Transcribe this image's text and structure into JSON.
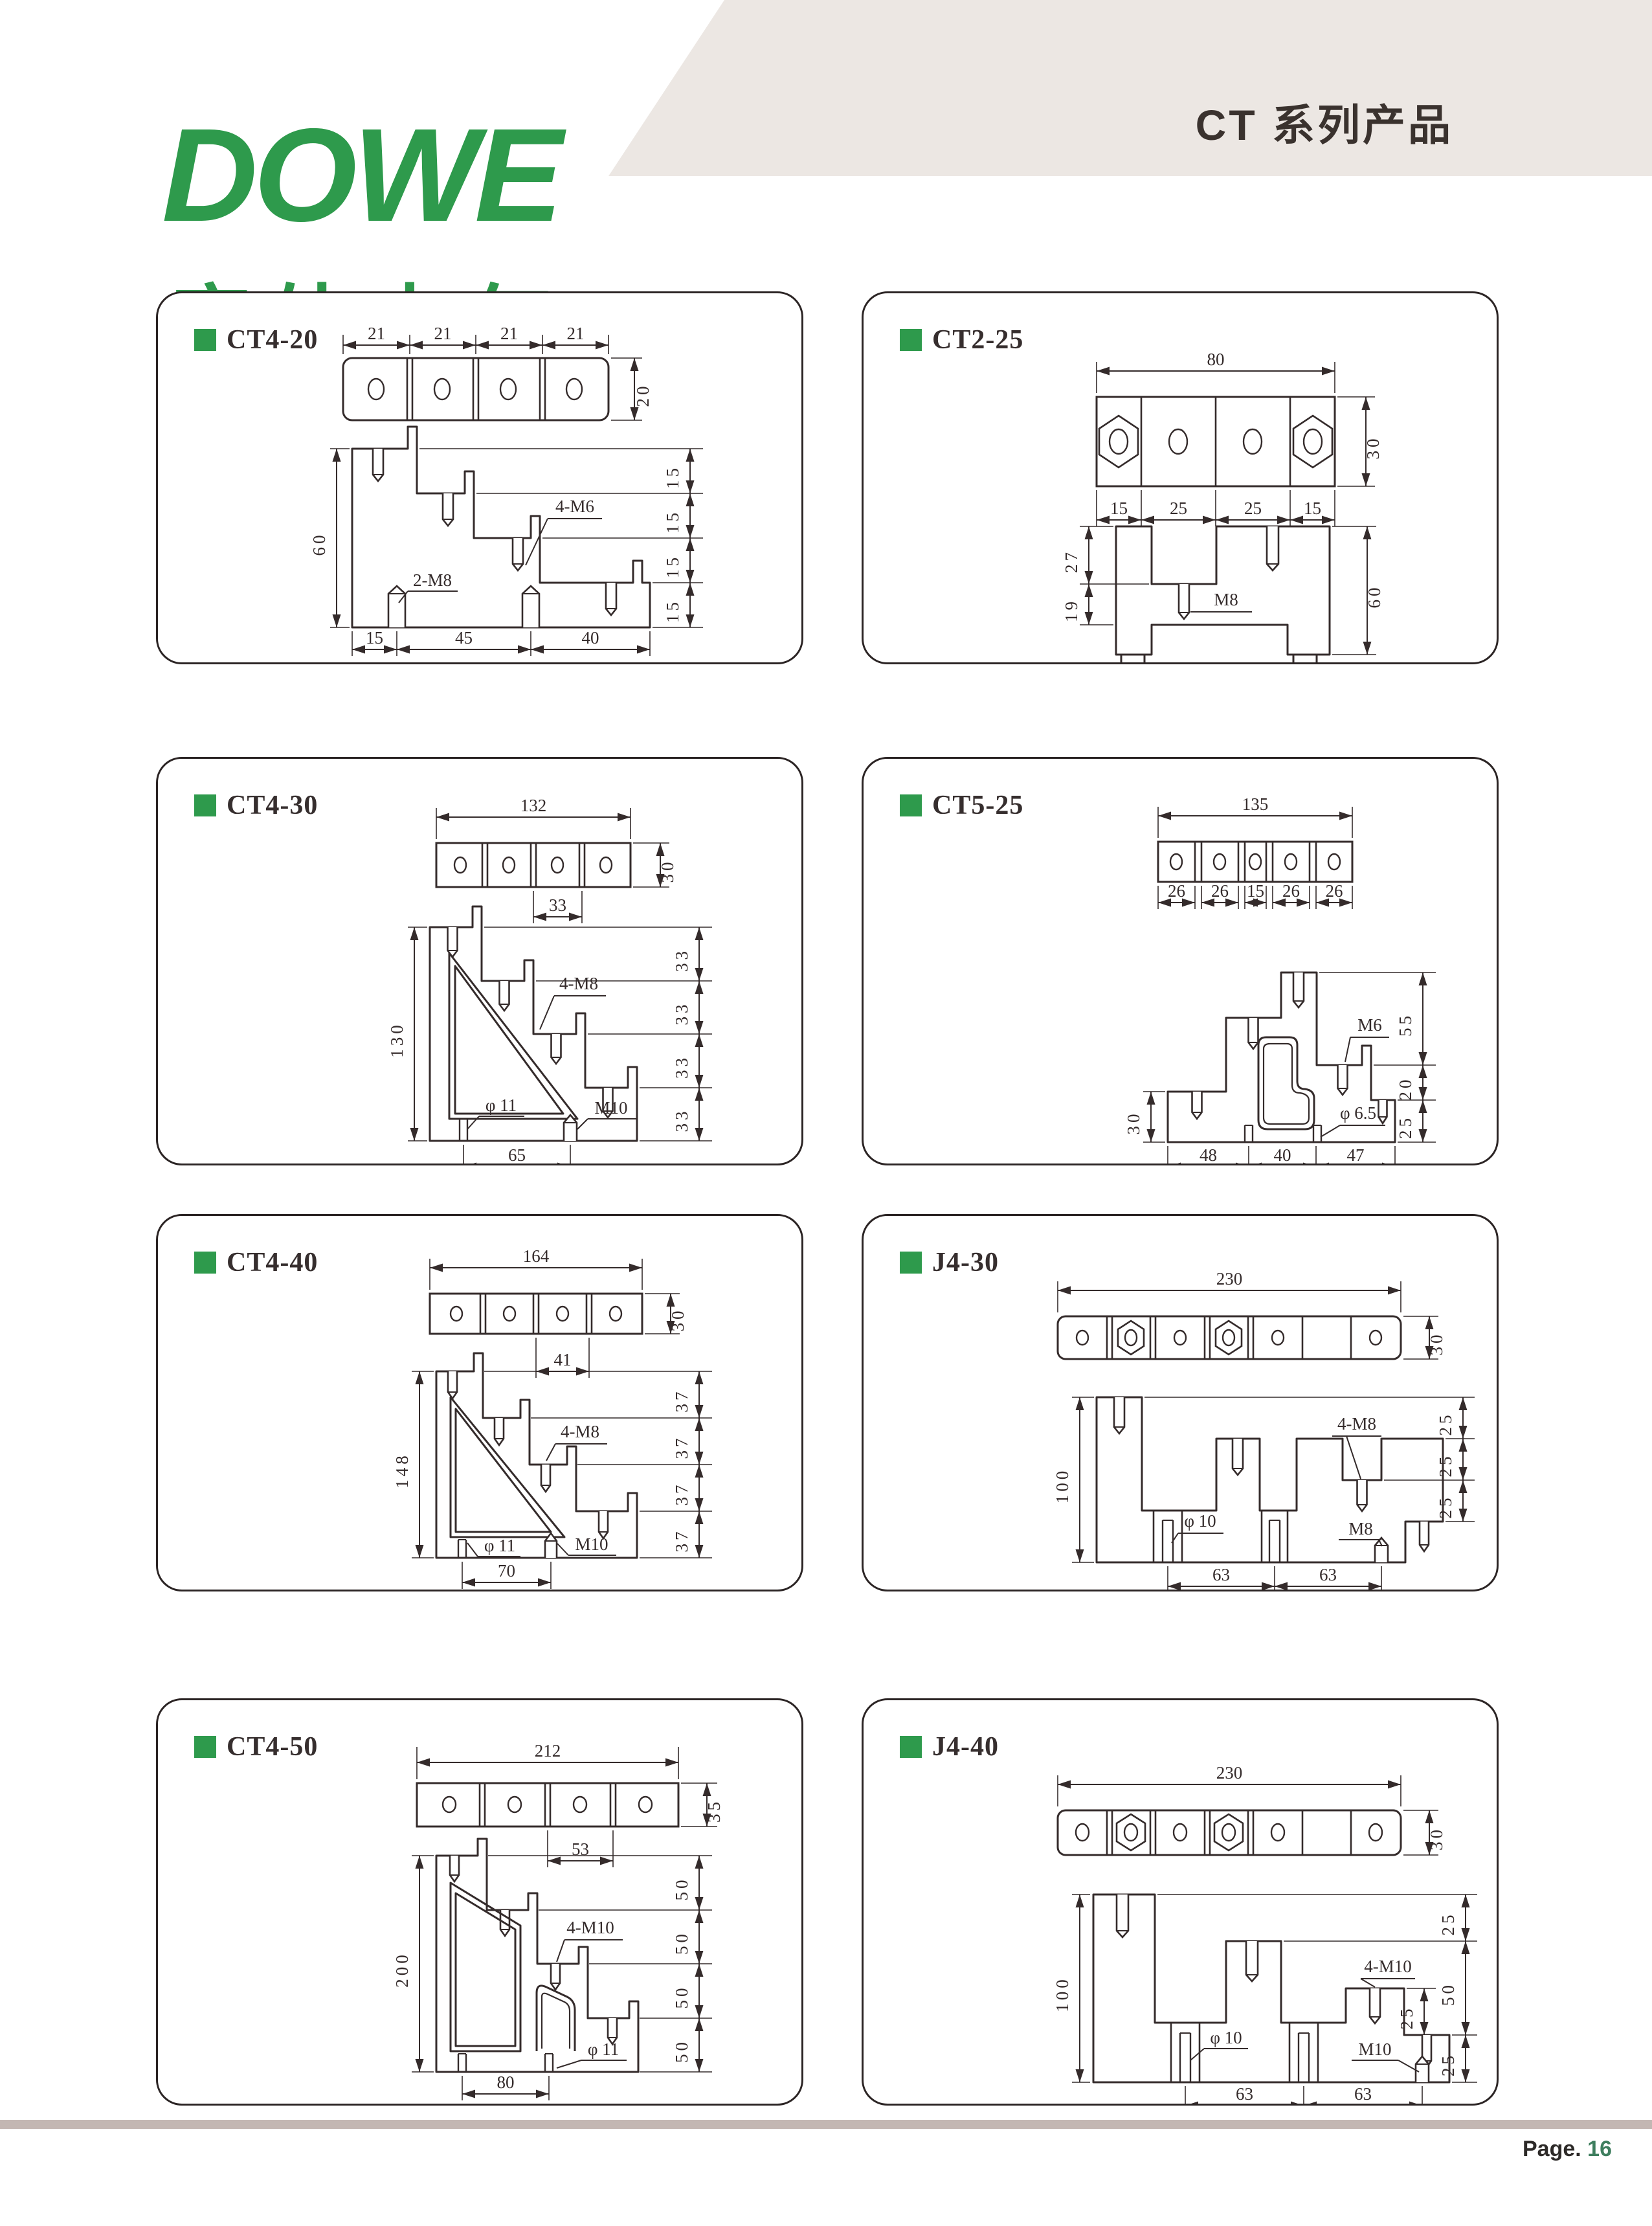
{
  "header": {
    "logo_text": "DOWE",
    "logo_sub": "度外电气",
    "title": "CT 系列产品",
    "brand_green": "#2e9a4c",
    "band_bg": "#ece7e3"
  },
  "footer": {
    "page_label": "Page.",
    "page_number": "16",
    "bar_color": "#c3b7b3",
    "number_color": "#3e7e5e"
  },
  "panels": [
    {
      "title": "CT4-20",
      "top_dims": [
        "21",
        "21",
        "21",
        "21"
      ],
      "bar_height": "20",
      "side_height": "60",
      "right_dims": [
        "15",
        "15",
        "15",
        "15"
      ],
      "bottom_dims": [
        "15",
        "45",
        "40"
      ],
      "labels": {
        "stud": "4-M6",
        "post": "2-M8"
      }
    },
    {
      "title": "CT2-25",
      "top_dim": "80",
      "bar_height": "30",
      "bottom_dims": [
        "15",
        "25",
        "25",
        "15"
      ],
      "left_dims": [
        "27",
        "19"
      ],
      "side_height": "60",
      "labels": {
        "stud": "M8"
      }
    },
    {
      "title": "CT4-30",
      "top_dim": "132",
      "bar_height": "30",
      "pitch_dim": "33",
      "side_height": "130",
      "right_dims": [
        "33",
        "33",
        "33",
        "33"
      ],
      "bottom_dim": "65",
      "labels": {
        "stud": "4-M8",
        "hole": "φ 11",
        "post": "M10"
      }
    },
    {
      "title": "CT5-25",
      "top_dim": "135",
      "bottom_dims": [
        "26",
        "26",
        "15",
        "26",
        "26"
      ],
      "left_dim": "30",
      "right_dims": [
        "55",
        "20",
        "25"
      ],
      "base_dims": [
        "48",
        "40",
        "47"
      ],
      "labels": {
        "stud": "M6",
        "hole": "φ 6.5"
      }
    },
    {
      "title": "CT4-40",
      "top_dim": "164",
      "bar_height": "30",
      "pitch_dim": "41",
      "side_height": "148",
      "right_dims": [
        "37",
        "37",
        "37",
        "37"
      ],
      "bottom_dim": "70",
      "labels": {
        "stud": "4-M8",
        "hole": "φ 11",
        "post": "M10"
      }
    },
    {
      "title": "J4-30",
      "top_dim": "230",
      "bar_height": "30",
      "side_height": "100",
      "right_dims": [
        "25",
        "25",
        "25"
      ],
      "bottom_dims": [
        "63",
        "63"
      ],
      "labels": {
        "stud": "4-M8",
        "hole": "φ 10",
        "post": "M8"
      }
    },
    {
      "title": "CT4-50",
      "top_dim": "212",
      "bar_height": "35",
      "pitch_dim": "53",
      "side_height": "200",
      "right_dims": [
        "50",
        "50",
        "50",
        "50"
      ],
      "bottom_dim": "80",
      "labels": {
        "stud": "4-M10",
        "hole": "φ 11"
      }
    },
    {
      "title": "J4-40",
      "top_dim": "230",
      "bar_height": "30",
      "side_height": "100",
      "right_dims": [
        "25",
        "50",
        "25"
      ],
      "step_dim": "25",
      "bottom_dims": [
        "63",
        "63"
      ],
      "labels": {
        "stud": "4-M10",
        "hole": "φ 10",
        "post": "M10"
      }
    }
  ]
}
